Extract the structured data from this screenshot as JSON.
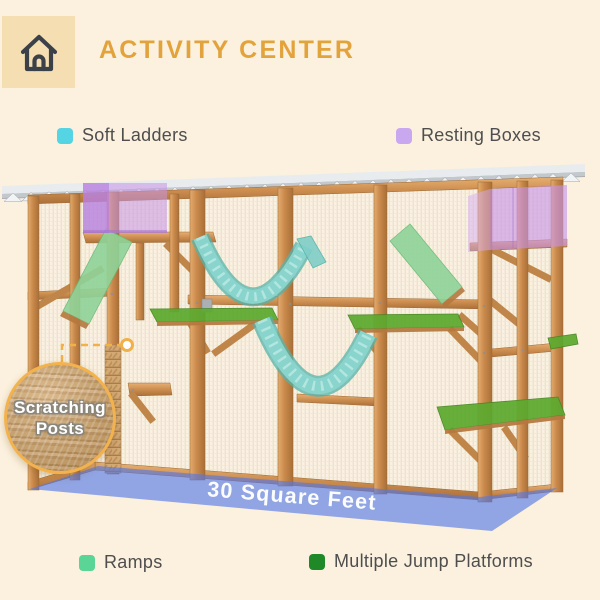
{
  "header": {
    "title": "ACTIVITY CENTER"
  },
  "legend_top": {
    "items": [
      {
        "label": "Soft Ladders",
        "color": "#55D4E4"
      },
      {
        "label": "Resting Boxes",
        "color": "#C9A8EF"
      }
    ]
  },
  "legend_bottom": {
    "items": [
      {
        "label": "Ramps",
        "color": "#5AD595"
      },
      {
        "label": "Multiple Jump Platforms",
        "color": "#1E8926"
      }
    ]
  },
  "diagram": {
    "floor_label": "30 Square Feet",
    "callout_label": "Scratching Posts",
    "colors": {
      "background": "#FBF1DE",
      "title": "#E3A33C",
      "home_badge": "#F5DFB2",
      "home_icon": "#3C4149",
      "legend_text": "#4E4E4E",
      "wood": "#C8884A",
      "roof": "#D7DBDE",
      "mesh": "#F9F2E3",
      "resting_box": "#C793E8",
      "soft_ladder": "#7FCEC8",
      "ramp": "#8FD398",
      "platform": "#5CA92F",
      "floor": "#5377E8",
      "floor_text": "#FFFFFF",
      "callout_ring": "#F2B24D"
    }
  }
}
